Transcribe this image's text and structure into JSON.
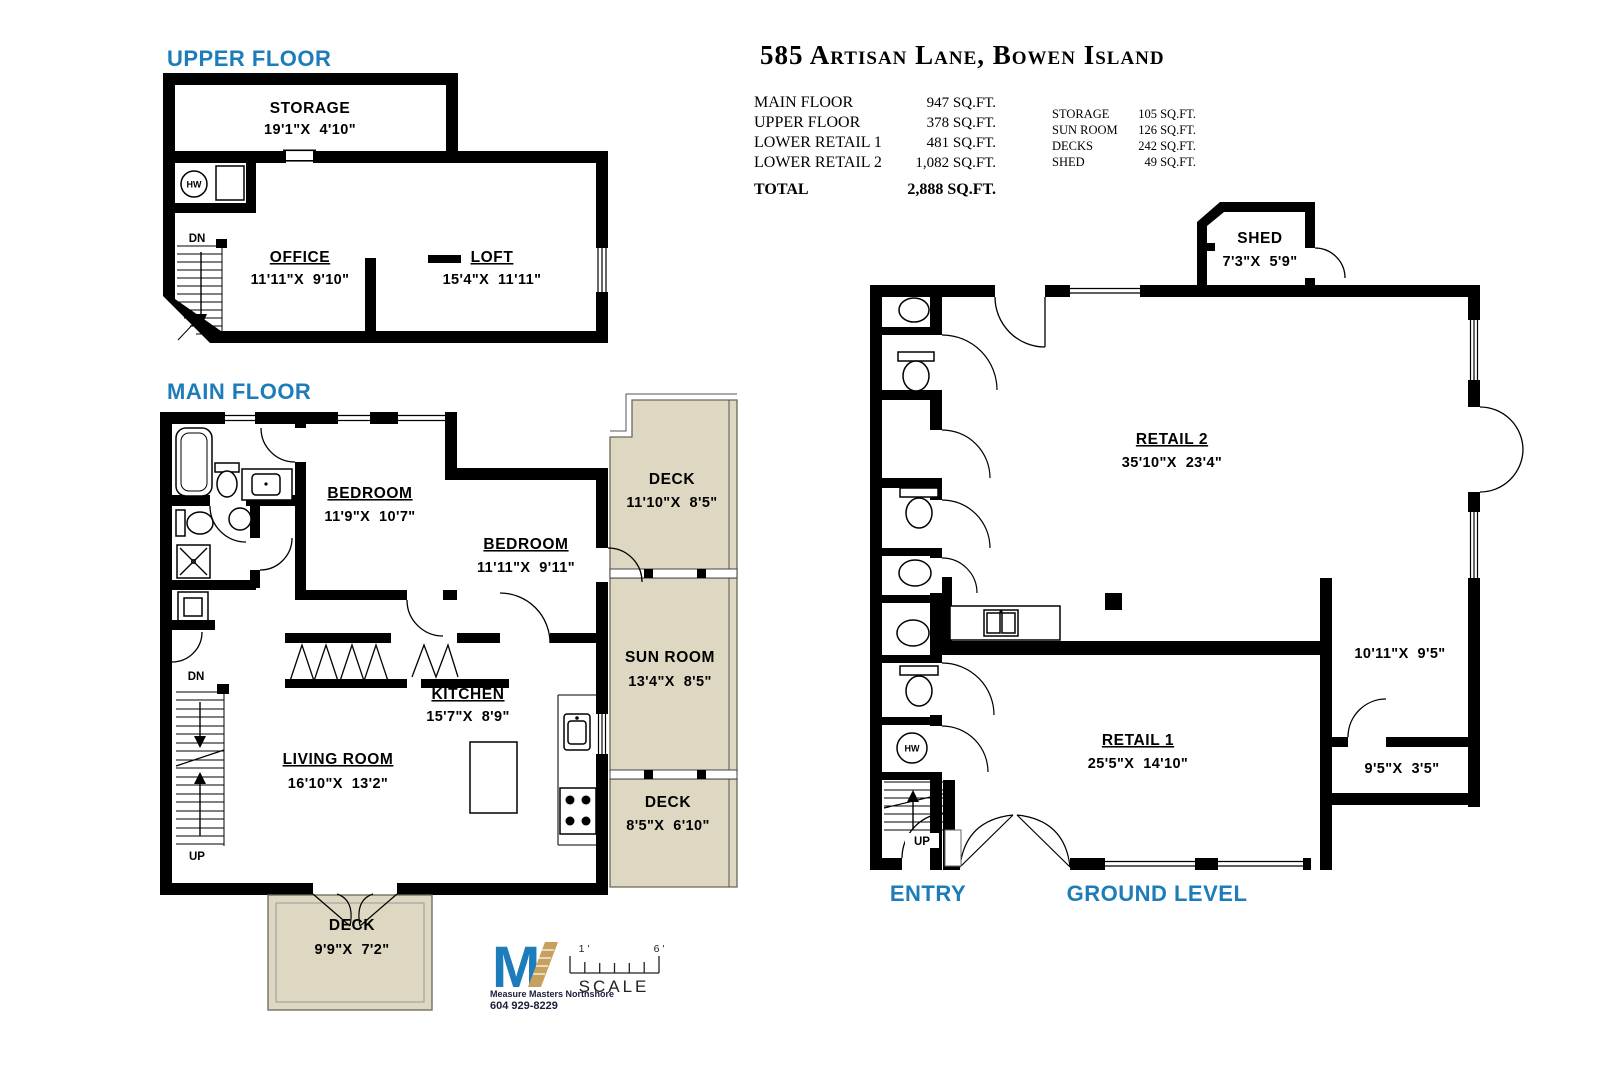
{
  "header": {
    "title": "585 Artisan Lane, Bowen Island",
    "summary_left": [
      {
        "label": "MAIN FLOOR",
        "value": "947 SQ.FT."
      },
      {
        "label": "UPPER FLOOR",
        "value": "378 SQ.FT."
      },
      {
        "label": "LOWER RETAIL 1",
        "value": "481 SQ.FT."
      },
      {
        "label": "LOWER RETAIL 2",
        "value": "1,082 SQ.FT."
      }
    ],
    "summary_right": [
      {
        "label": "STORAGE",
        "value": "105 SQ.FT."
      },
      {
        "label": "SUN ROOM",
        "value": "126 SQ.FT."
      },
      {
        "label": "DECKS",
        "value": "242 SQ.FT."
      },
      {
        "label": "SHED",
        "value": "49 SQ.FT."
      }
    ],
    "total": {
      "label": "TOTAL",
      "value": "2,888 SQ.FT."
    }
  },
  "floors": {
    "upper": {
      "heading": "UPPER FLOOR",
      "rooms": {
        "storage": {
          "name": "STORAGE",
          "dims": "19'1\"X  4'10\""
        },
        "office": {
          "name": "OFFICE",
          "dims": "11'11\"X  9'10\""
        },
        "loft": {
          "name": "LOFT",
          "dims": "15'4\"X  11'11\""
        }
      },
      "labels": {
        "dn": "DN",
        "hw": "HW"
      }
    },
    "main": {
      "heading": "MAIN FLOOR",
      "rooms": {
        "bedroom1": {
          "name": "BEDROOM",
          "dims": "11'9\"X  10'7\""
        },
        "bedroom2": {
          "name": "BEDROOM",
          "dims": "11'11\"X  9'11\""
        },
        "kitchen": {
          "name": "KITCHEN",
          "dims": "15'7\"X  8'9\""
        },
        "living": {
          "name": "LIVING ROOM",
          "dims": "16'10\"X  13'2\""
        },
        "deck_upper": {
          "name": "DECK",
          "dims": "11'10\"X  8'5\""
        },
        "sunroom": {
          "name": "SUN ROOM",
          "dims": "13'4\"X  8'5\""
        },
        "deck_mid": {
          "name": "DECK",
          "dims": "8'5\"X  6'10\""
        },
        "deck_bottom": {
          "name": "DECK",
          "dims": "9'9\"X  7'2\""
        }
      },
      "labels": {
        "dn": "DN",
        "up": "UP"
      }
    },
    "ground": {
      "heading": "GROUND LEVEL",
      "entry": "ENTRY",
      "rooms": {
        "shed": {
          "name": "SHED",
          "dims": "7'3\"X  5'9\""
        },
        "retail2": {
          "name": "RETAIL 2",
          "dims": "35'10\"X  23'4\""
        },
        "retail1": {
          "name": "RETAIL 1",
          "dims": "25'5\"X  14'10\""
        },
        "side_room_upper": {
          "dims": "10'11\"X  9'5\""
        },
        "side_room_lower": {
          "dims": "9'5\"X  3'5\""
        }
      },
      "labels": {
        "up": "UP",
        "hw": "HW"
      }
    }
  },
  "footer": {
    "logo": {
      "mark": "M",
      "name": "Measure Masters Northshore",
      "phone": "604 929-8229"
    },
    "scale": {
      "label": "SCALE",
      "left_tick": "1 '",
      "right_tick": "6 '"
    }
  },
  "colors": {
    "accent_blue": "#1d7cba",
    "deck_fill": "#ded8c2",
    "logo_gold": "#c6a05c",
    "wall": "#000000"
  }
}
